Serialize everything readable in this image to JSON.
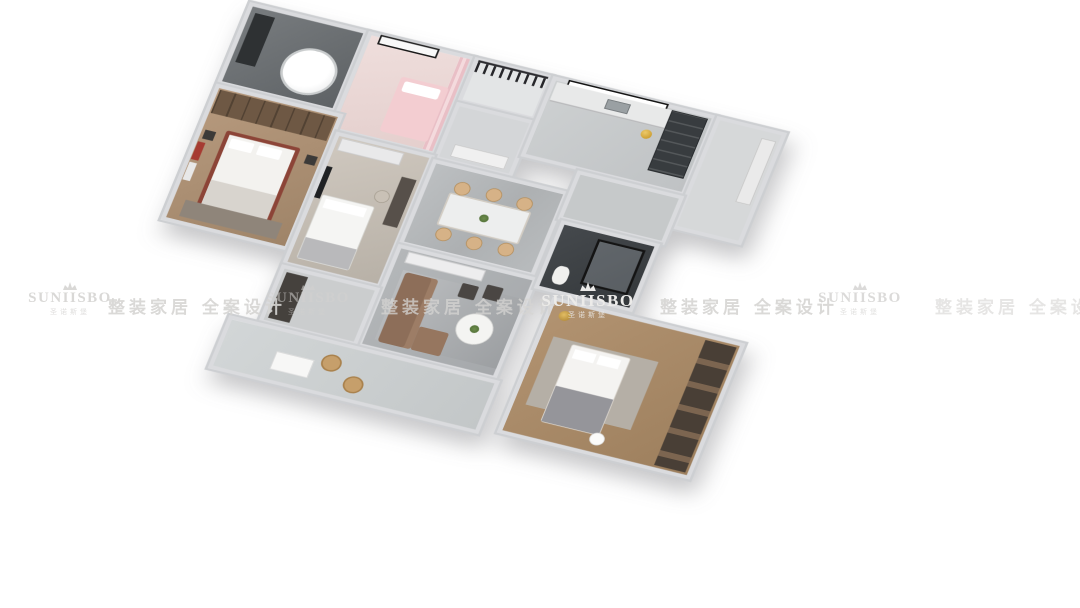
{
  "watermark": {
    "brand": "SUNIISBO",
    "brand_sub": "圣诺斯堡",
    "tagline": "整装家居 全案设计",
    "repeat_count": 4,
    "crown_icon": "crown-icon",
    "color": "#d3d2d0"
  },
  "palette": {
    "background": "#ffffff",
    "walls": "#dadbde",
    "marble_floor": "#b6b9bb",
    "wood_floor": "#aa8b68",
    "kids_room_pink": "#ecd9d6",
    "master_bed_frame_red": "#8c4437",
    "sofa_leather_brown": "#8d6e59",
    "dining_chair_tan": "#d6b287",
    "dark_fixtures": "#383c3f",
    "railing_black": "#26262a",
    "gold_accent": "#d9a937"
  }
}
